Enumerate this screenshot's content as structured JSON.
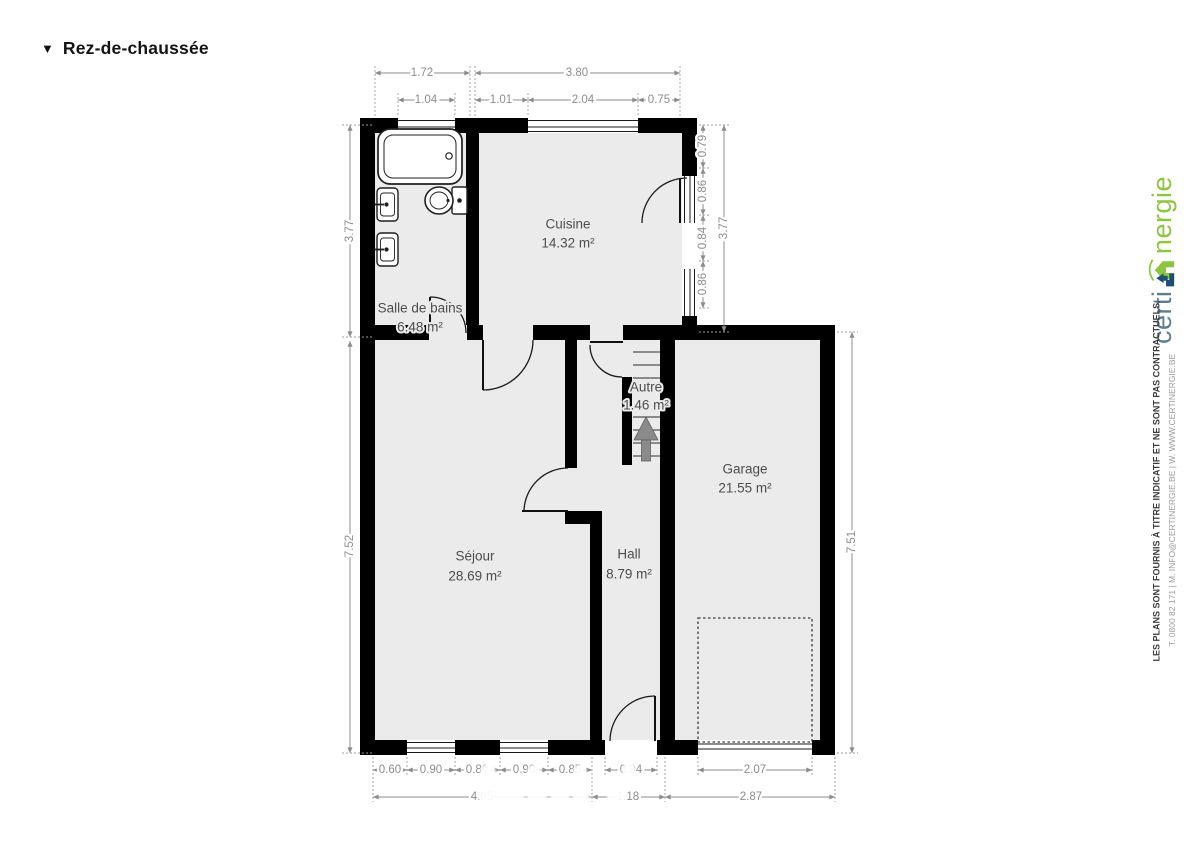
{
  "header": {
    "collapse_icon": "▼",
    "title": "Rez-de-chaussée"
  },
  "rooms": {
    "salle_de_bains": {
      "name": "Salle de bains",
      "area": "6.48 m²"
    },
    "cuisine": {
      "name": "Cuisine",
      "area": "14.32 m²"
    },
    "autre": {
      "name": "Autre",
      "area": "1.46 m²"
    },
    "garage": {
      "name": "Garage",
      "area": "21.55 m²"
    },
    "sejour": {
      "name": "Séjour",
      "area": "28.69 m²"
    },
    "hall": {
      "name": "Hall",
      "area": "8.79 m²"
    }
  },
  "dimensions": {
    "top_outer": [
      "1.72",
      "3.80"
    ],
    "top_inner": [
      "1.04",
      "1.01",
      "2.04",
      "0.75"
    ],
    "left": [
      "3.77",
      "7.52"
    ],
    "right_kitchen": [
      "0.79",
      "0.86",
      "0.84",
      "0.86"
    ],
    "right_kitchen_total": "3.77",
    "right_garage": "7.51",
    "bottom_inner": [
      "0.60",
      "0.90",
      "0.80",
      "0.90",
      "0.85",
      "0.94"
    ],
    "garage_door_width": "2.07",
    "bottom_outer": [
      "4.05",
      "1.18",
      "2.87"
    ]
  },
  "branding": {
    "logo_text_1": "certi",
    "logo_text_2": "nergie",
    "disclaimer_line_1": "LES PLANS SONT FOURNIS À TITRE INDICATIF ET NE SONT PAS CONTRACTUELS.",
    "disclaimer_line_2": "T. 0800 82 171 | M. INFO@CERTINERGIE.BE | W. WWW.CERTINERGIE.BE"
  },
  "colors": {
    "wall": "#000000",
    "room_fill": "#ebebeb",
    "dimension": "#8c8c8c",
    "room_label": "#4d4d4d",
    "logo_blue": "#5e7e8f",
    "logo_green": "#8cc63f",
    "stairs_arrow": "#8a8a8a"
  }
}
